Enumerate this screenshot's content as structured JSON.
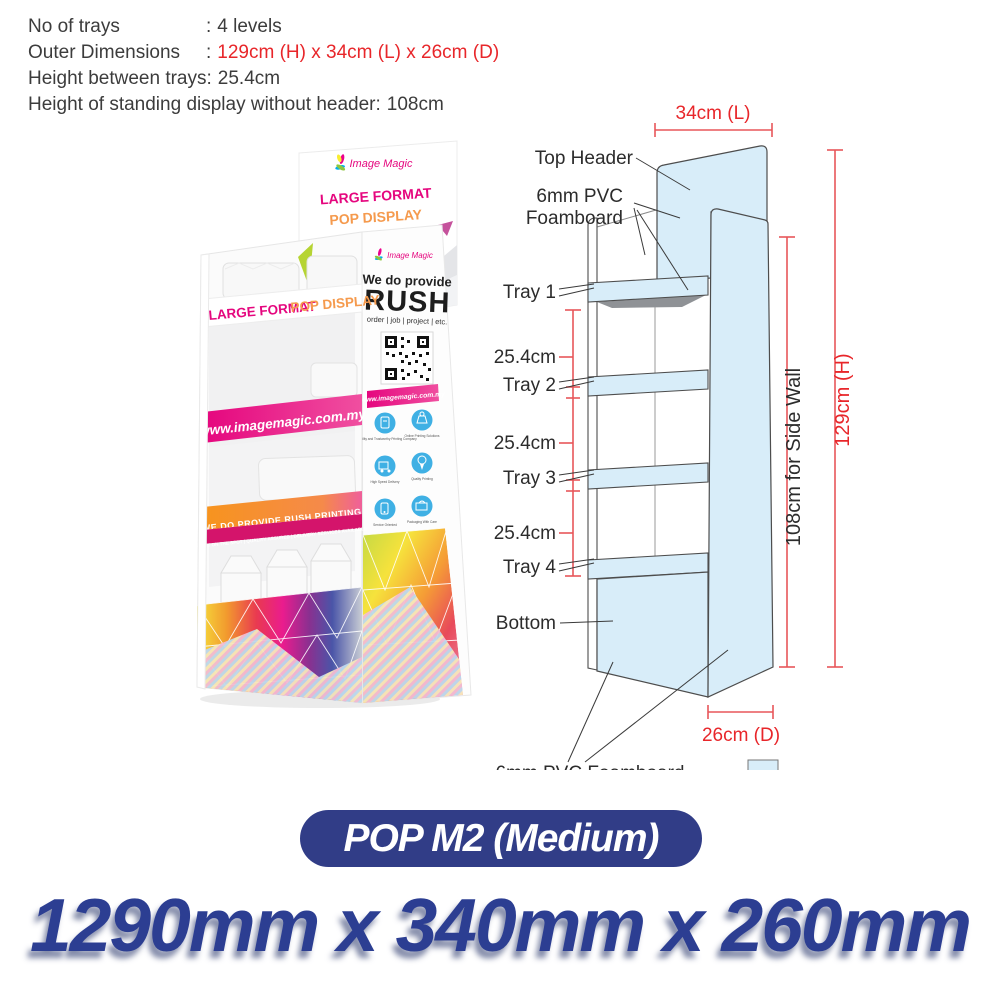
{
  "specs": {
    "separator": ":",
    "rows": [
      {
        "label": "No of trays",
        "value": "4 levels"
      },
      {
        "label": "Outer Dimensions",
        "value": "129cm (H) x 34cm (L) x 26cm (D)"
      },
      {
        "label": "Height between trays",
        "value": "25.4cm"
      },
      {
        "label": "Height of standing display without header",
        "value": "108cm"
      }
    ]
  },
  "photo": {
    "header_brand": "Image Magic",
    "header_line1": "LARGE FORMAT",
    "header_line2": "POP DISPLAY",
    "tray_line1": "LARGE FORMAT",
    "tray_line2": "POP DISPLAY",
    "url_banner": "www.imagemagic.com.my",
    "side_brand": "Image Magic",
    "side_we_do": "We do provide",
    "side_rush": "RUSH",
    "side_tagline": "order | job | project | etc.",
    "side_url": "www.imagemagic.com.my",
    "rush_banner": "WE DO PROVIDE RUSH PRINTING",
    "sub_banner": "PRINT ON THE SPOT | QUALITY ASSURED | DELIVERY SERVICES AVAILABLE",
    "icon_captions": [
      "Reliability and Trustworthy Printing Company",
      "Online Printing Solutions",
      "High Speed Delivery",
      "Quality Printing",
      "Service Oriented",
      "Packaging With Care"
    ]
  },
  "diagram": {
    "width_dim": "34cm (L)",
    "height_dim": "129cm (H)",
    "side_wall_dim": "108cm  for Side Wall",
    "depth_dim": "26cm (D)",
    "gap_dim": "25.4cm",
    "label_top_header": "Top Header",
    "label_foam1": "6mm PVC",
    "label_foam2": "Foamboard",
    "label_tray1": "Tray 1",
    "label_tray2": "Tray 2",
    "label_tray3": "Tray 3",
    "label_tray4": "Tray 4",
    "label_bottom": "Bottom",
    "label_foam_bottom": "6mm PVC Foamboard",
    "legend_label": "Printable Area"
  },
  "footer": {
    "badge": "POP M2 (Medium)",
    "size_text": "1290mm x 340mm x 260mm"
  },
  "colors": {
    "printable_area": "#d8edf9",
    "dimension_red": "#e8565a",
    "text_red": "#e8262a",
    "navy": "#313d87",
    "magenta": "#e5067e",
    "orange": "#f7941d"
  }
}
